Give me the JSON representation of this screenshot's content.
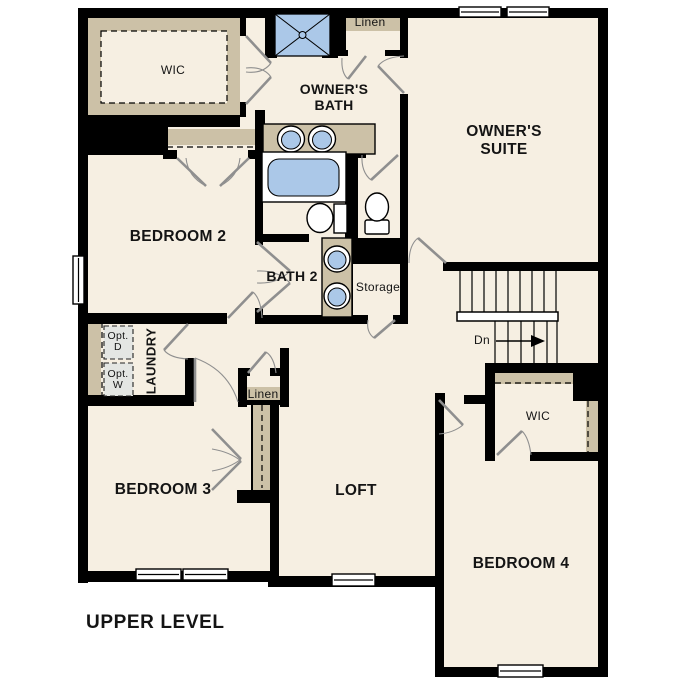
{
  "title": "UPPER LEVEL",
  "colors": {
    "wall": "#000000",
    "floor": "#f6efe2",
    "shelf": "#ccc1a7",
    "fixture": "#abc8e8",
    "optbox": "#e4e6e3",
    "leaf": "#8f8f8f",
    "text": "#141414"
  },
  "rooms": {
    "wic_top": "WIC",
    "owners_bath": "OWNER'S\nBATH",
    "owners_suite": "OWNER'S\nSUITE",
    "bedroom2": "BEDROOM 2",
    "bath2": "BATH 2",
    "storage": "Storage",
    "laundry": "LAUNDRY",
    "linen_top": "Linen",
    "linen_mid": "Linen",
    "bedroom3": "BEDROOM 3",
    "loft": "LOFT",
    "wic_right": "WIC",
    "bedroom4": "BEDROOM 4"
  },
  "appliances": {
    "opt_dryer": "Opt.\nD",
    "opt_washer": "Opt.\nW"
  },
  "stairs": {
    "direction_label": "Dn"
  }
}
